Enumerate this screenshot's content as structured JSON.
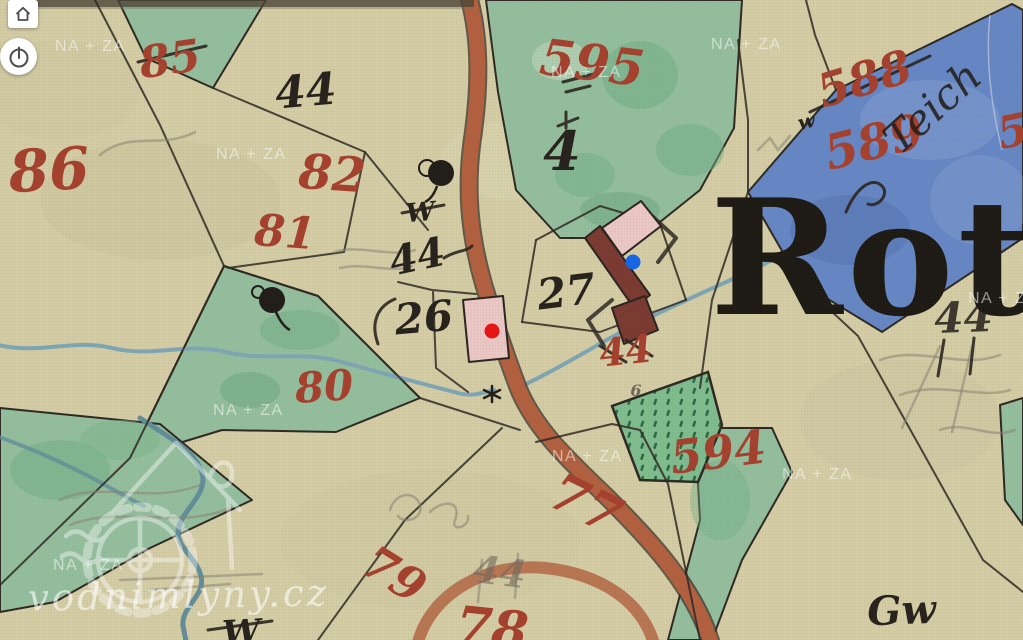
{
  "watermarks": {
    "tile": "NA + ZA",
    "site": "vodnimlyny.cz"
  },
  "controls": {
    "home_icon": "home-icon",
    "time_icon": "clock-icon"
  },
  "markers": {
    "primary": {
      "name": "selected-mill-marker",
      "color": "#e81413"
    },
    "secondary": {
      "name": "mill-marker",
      "color": "#1565e8"
    }
  },
  "palette": {
    "paper": "#d4cda6",
    "meadow": "#94bf9e",
    "pond": "#6687c6",
    "road": "#b2603f",
    "building_light": "#ecc8c6",
    "building_dark": "#7b3a31",
    "stream": "#7fa6b5",
    "number_red": "#a5402e",
    "ink": "#26211c"
  },
  "labels": {
    "red": [
      {
        "text": "86"
      },
      {
        "text": "85"
      },
      {
        "text": "82"
      },
      {
        "text": "81"
      },
      {
        "text": "80"
      },
      {
        "text": "595"
      },
      {
        "text": "588"
      },
      {
        "text": "589"
      },
      {
        "text": "5"
      },
      {
        "text": "594"
      },
      {
        "text": "44"
      },
      {
        "text": "77"
      },
      {
        "text": "79"
      },
      {
        "text": "78"
      }
    ],
    "black": [
      {
        "text": "44"
      },
      {
        "text": "4"
      },
      {
        "text": "44"
      },
      {
        "text": "26"
      },
      {
        "text": "27"
      },
      {
        "text": "44"
      },
      {
        "text": "W"
      },
      {
        "text": "W"
      },
      {
        "text": "w"
      },
      {
        "text": "Gw"
      },
      {
        "text": "6"
      },
      {
        "text": "44"
      }
    ],
    "place_name": "Roth",
    "pond_script": "Teich"
  }
}
